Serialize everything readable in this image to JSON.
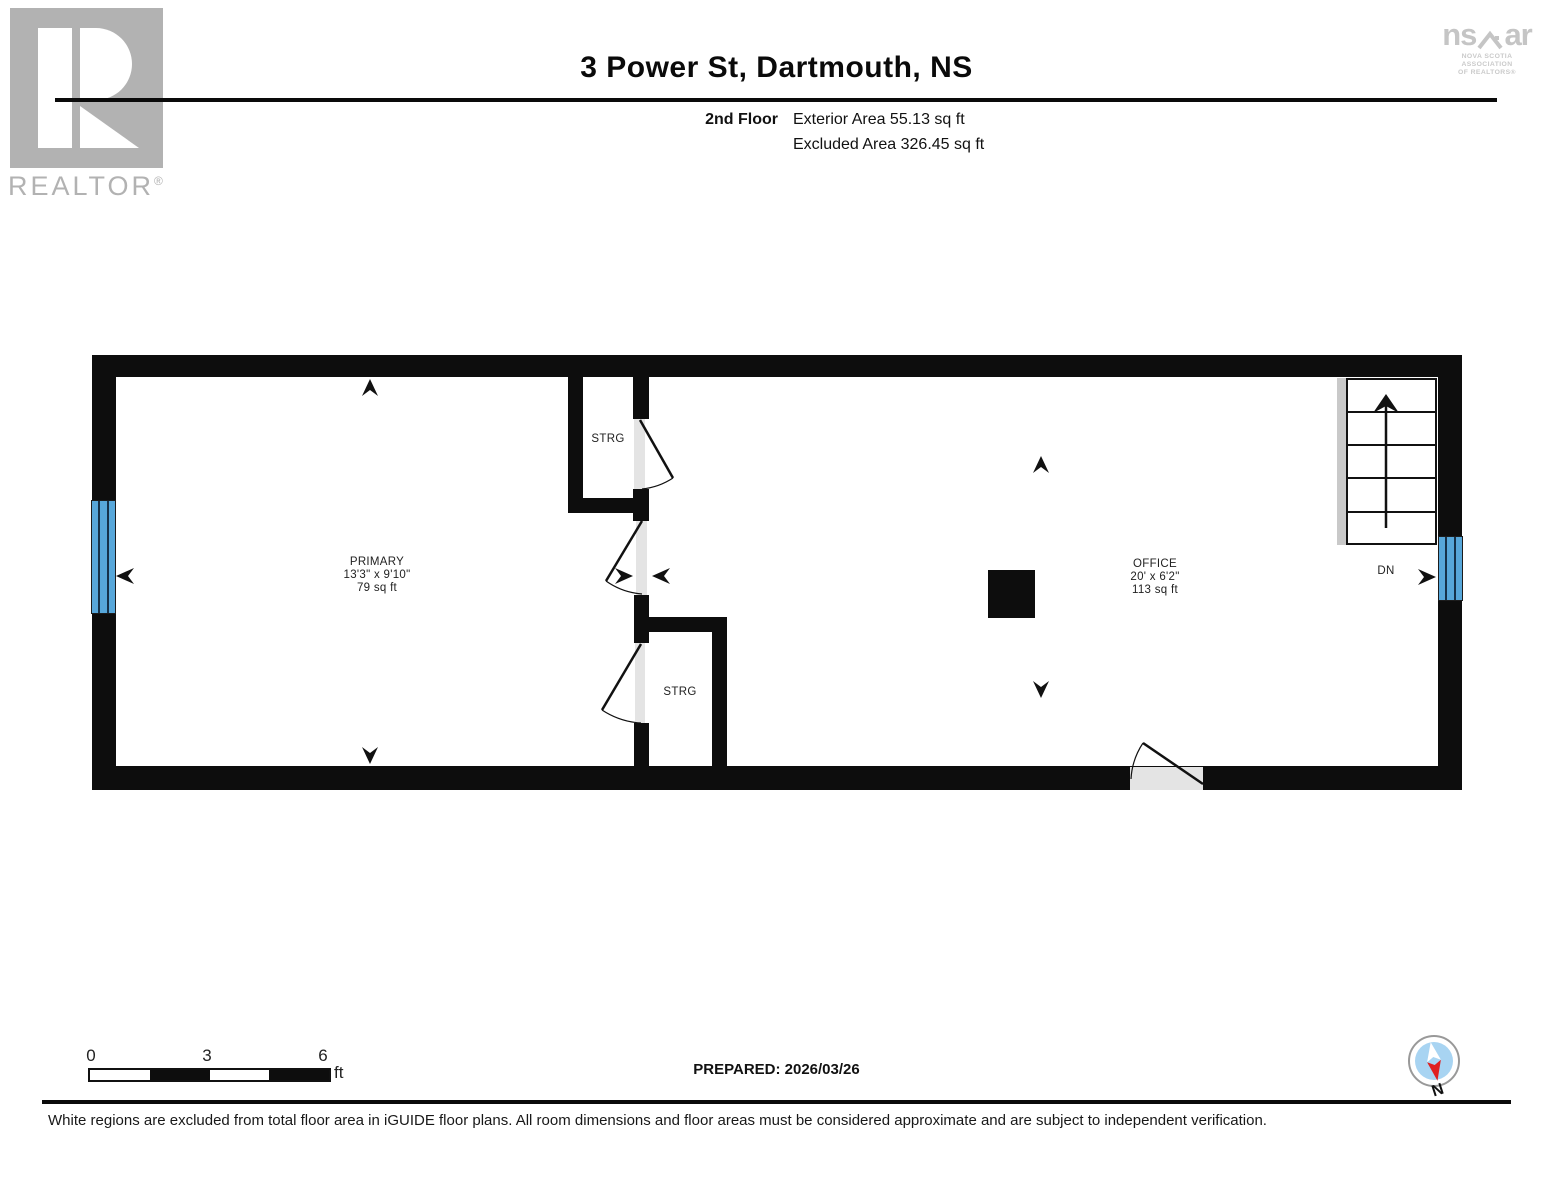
{
  "header": {
    "realtor_logo_text": "REALTOR",
    "registered_mark": "®",
    "title": "3 Power St, Dartmouth, NS",
    "floor_label": "2nd Floor",
    "exterior_area": "Exterior Area 55.13 sq ft",
    "excluded_area": "Excluded Area 326.45 sq ft",
    "nsar_logo": {
      "ns": "ns",
      "ar": "ar",
      "caption_line1": "NOVA SCOTIA ASSOCIATION",
      "caption_line2": "OF REALTORS®"
    }
  },
  "floor_plan": {
    "rooms": {
      "primary": {
        "name": "PRIMARY",
        "dimensions": "13'3\" x 9'10\"",
        "area": "79 sq ft"
      },
      "office": {
        "name": "OFFICE",
        "dimensions": "20' x 6'2\"",
        "area": "113 sq ft"
      },
      "storage_top": {
        "name": "STRG"
      },
      "storage_bottom": {
        "name": "STRG"
      }
    },
    "stairs_label": "DN"
  },
  "footer": {
    "scale": {
      "tick0": "0",
      "tick1": "3",
      "tick2": "6",
      "unit": "ft"
    },
    "prepared": "PREPARED: 2026/03/26",
    "compass_label": "N",
    "disclaimer": "White regions are excluded from total floor area in iGUIDE floor plans. All room dimensions and floor areas must be considered approximate and are subject to independent verification."
  },
  "colors": {
    "wall": "#0d0d0d",
    "window_blue": "#57a7da",
    "door_gray": "#e4e4e4",
    "stair_gray": "#c9c9c9",
    "compass_blue": "#a8d4f2",
    "compass_red": "#e01f1f",
    "logo_gray": "#b2b2b2"
  }
}
